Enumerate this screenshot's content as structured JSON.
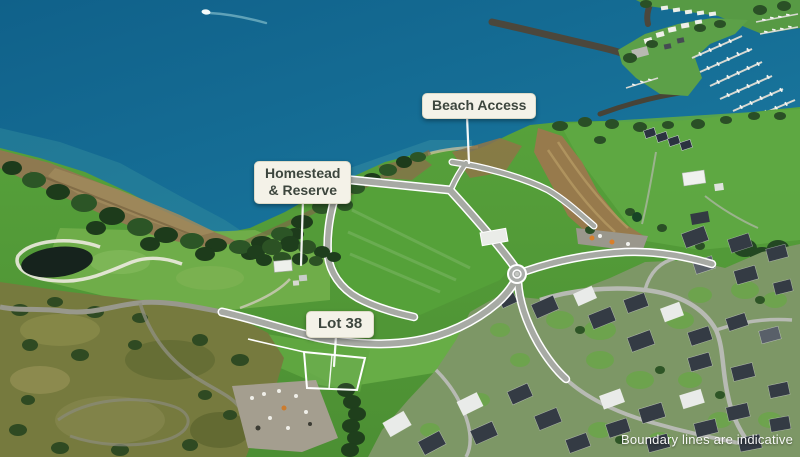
{
  "annotations": {
    "beach_access": {
      "label": "Beach Access"
    },
    "homestead_reserve": {
      "line1": "Homestead",
      "line2": "& Reserve"
    },
    "lot_38": {
      "label": "Lot 38"
    }
  },
  "disclaimer": {
    "text": "Boundary lines are indicative"
  },
  "colors": {
    "ocean_deep": "#10618a",
    "ocean": "#1d7fa5",
    "shallow_water": "#2f8a9b",
    "grass": "#57a23b",
    "grass_dark": "#4c8f33",
    "trees": "#1d3b1b",
    "scrub": "#767a3e",
    "tidal_flat": "#8e7950",
    "dirt": "#977a4c",
    "road": "#a7aaa4",
    "road_edge": "#ffffff",
    "residential_street": "#b7bab3",
    "roof_dark": "#343b44",
    "roof_light": "#e9ebe9",
    "breakwater": "#4b473c",
    "boundary_line": "#ffffff",
    "label_bg": "#f4f2e8",
    "label_text": "#3d463e",
    "disclaimer_text": "#ffffff"
  }
}
